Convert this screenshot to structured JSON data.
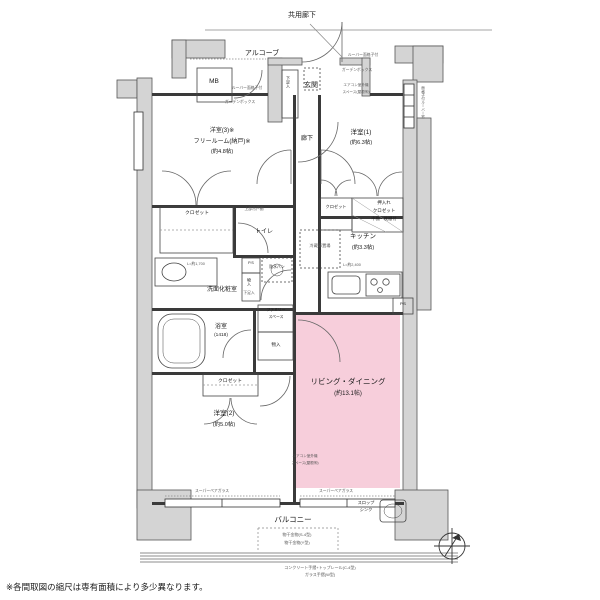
{
  "labels": {
    "common_corridor": "共用廊下",
    "alcove": "アルコーブ",
    "mb": "MB",
    "entrance": "玄関",
    "corridor": "廊下",
    "room1_name": "洋室(1)",
    "room1_size": "(約6.3帖)",
    "room3_line1": "洋室(3)※",
    "room3_line2": "フリールーム(納戸)※",
    "room3_size": "(約4.8帖)",
    "room2_name": "洋室(2)",
    "room2_size": "(約5.0帖)",
    "living_name": "リビング・ダイニング",
    "living_size": "(約13.1帖)",
    "kitchen_name": "キッチン",
    "kitchen_size": "(約3.3帖)",
    "kitchen_counter": "L=約2,400",
    "fridge": "冷蔵庫置場",
    "bath_name": "浴室",
    "bath_size": "(1418)",
    "wash": "洗面化粧室",
    "wash_counter": "L=約1,700",
    "toilet": "トイレ",
    "toilet_shelf": "上部吊戸棚",
    "closet": "クロゼット",
    "oshiire_l1": "押入れ",
    "oshiire_l2": "クロゼット",
    "oshiire_l3": "中棚・枕棚付",
    "storage": "物入",
    "ps": "P.S",
    "waterproof_pan": "防水パン",
    "shoe_box": "下足入",
    "family_space_l1": "ファミリー",
    "family_space_l2": "スペース",
    "aircon_l1": "エアコン室外機",
    "aircon_l2": "スペース(屋根㈲)",
    "louver": "ルーバー面格子付",
    "garden_box": "ガーデンボックス",
    "louver_window_v": "面格子付ルーバー窓",
    "balcony": "バルコニー",
    "slop_sink_l1": "スロップ",
    "slop_sink_l2": "シンク",
    "drying1": "物干金物(S-4型)",
    "drying2": "物干金物(Y型)",
    "glass": "スーパーペアガラス",
    "handrail_l1": "コンクリート手摺+トップレール(C-4型)",
    "handrail_l2": "ガラス手摺(W型)",
    "disclaimer": "※各間取図の縮尺は専有面積により多少異なります。"
  },
  "colors": {
    "living_pink": "#f7cedb",
    "wall_gray": "#d4d4d4",
    "line_dark": "#3a3a3a"
  }
}
